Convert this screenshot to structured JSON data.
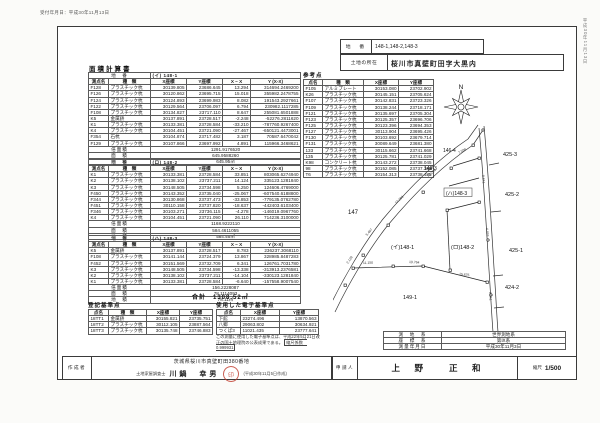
{
  "meta": {
    "top_note": "受付年月日：平成30年11月13日",
    "side_note": "平成30年11月13日"
  },
  "header": {
    "chiban_label": "地　番",
    "chiban": "148-1,148-2,148-3",
    "shozai_label": "土地の所在",
    "shozai": "桜川市真壁町田字大黒内"
  },
  "area_calc": {
    "title": "面積計算書",
    "tables": [
      {
        "rows": [
          [
            {
              "t": "地　番",
              "span": 2,
              "c": "lb"
            },
            {
              "t": "(イ) 148-1",
              "span": 4,
              "c": "tl"
            }
          ],
          [
            {
              "t": "測点名",
              "c": "h"
            },
            {
              "t": "種　類",
              "c": "h"
            },
            {
              "t": "X座標",
              "c": "h"
            },
            {
              "t": "Y座標",
              "c": "h"
            },
            {
              "t": "X − X",
              "c": "h"
            },
            {
              "t": "Y (X-X)",
              "c": "h"
            }
          ],
          [
            "F128",
            "プラスチック杭",
            "30139.805",
            "23686.645",
            "13.294",
            "314694.2469200"
          ],
          [
            "F126",
            "プラスチック杭",
            "30120.862",
            "23695.715",
            "15.018",
            "355982.2478755"
          ],
          [
            "F124",
            "プラスチック杭",
            "30124.893",
            "23699.983",
            "8.082",
            "191543.2927661"
          ],
          [
            "F122",
            "プラスチック杭",
            "30129.564",
            "23706.097",
            "6.794",
            "230982.1117285"
          ],
          [
            "F108",
            "プラスチック杭",
            "30134.827",
            "23717.110",
            "8.647",
            "255081.6501888"
          ],
          [
            "K5",
            "金属鋲",
            "30137.891",
            "23728.517",
            "-2.248",
            "-52276.2811620"
          ],
          [
            "K1",
            "プラスチック杭",
            "30133.381",
            "23728.584",
            "-33.210",
            "-787760.9267400"
          ],
          [
            "K4",
            "プラスチック杭",
            "30104.451",
            "23721.090",
            "-27.467",
            "-650121.4473001"
          ],
          [
            "F354",
            "石杭",
            "30104.874",
            "23717.482",
            "3.187",
            "70587.6470042"
          ],
          [
            "F129",
            "プラスチック杭",
            "30107.866",
            "23697.992",
            "4.891",
            "115966.3468621"
          ],
          [
            {
              "t": "倍面積",
              "span": 2,
              "c": "lb"
            },
            {
              "t": "1291.9176520",
              "span": 4,
              "c": "ct"
            }
          ],
          [
            {
              "t": "面　積",
              "span": 2,
              "c": "lb"
            },
            {
              "t": "645.9588260",
              "span": 4,
              "c": "ct"
            }
          ],
          [
            {
              "t": "地　積",
              "span": 2,
              "c": "lb"
            },
            {
              "t": "645.95㎡",
              "span": 4,
              "c": "ct"
            }
          ]
        ]
      },
      {
        "rows": [
          [
            {
              "t": "地　番",
              "span": 2,
              "c": "lb"
            },
            {
              "t": "(ロ) 148-2",
              "span": 4,
              "c": "tl"
            }
          ],
          [
            {
              "t": "測点名",
              "c": "h"
            },
            {
              "t": "種　類",
              "c": "h"
            },
            {
              "t": "X座標",
              "c": "h"
            },
            {
              "t": "Y座標",
              "c": "h"
            },
            {
              "t": "X − X",
              "c": "h"
            },
            {
              "t": "Y (X-X)",
              "c": "h"
            }
          ],
          [
            "K1",
            "プラスチック杭",
            "30133.381",
            "23728.584",
            "33.851",
            "803065.6274940"
          ],
          [
            "K2",
            "プラスチック杭",
            "30138.102",
            "23737.211",
            "14.124",
            "335123.1281840"
          ],
          [
            "K3",
            "プラスチック杭",
            "30148.505",
            "23734.598",
            "5.250",
            "124606.4769000"
          ],
          [
            "F450",
            "プラスチック杭",
            "30143.352",
            "23735.040",
            "-25.067",
            "-607540.6188800"
          ],
          [
            "F344",
            "プラスチック杭",
            "30130.868",
            "23737.473",
            "-33.853",
            "-779135.0762780"
          ],
          [
            "F451",
            "プラスチック杭",
            "30110.158",
            "23737.820",
            "-18.637",
            "-442403.6103400"
          ],
          [
            "F346",
            "プラスチック杭",
            "30103.271",
            "23736.115",
            "-4.278",
            "-146019.0967760"
          ],
          [
            "K4",
            "プラスチック杭",
            "30104.451",
            "23721.090",
            "26.110",
            "714236.3100000"
          ],
          [
            {
              "t": "倍面積",
              "span": 2,
              "c": "lb"
            },
            {
              "t": "1168.9222110",
              "span": 4,
              "c": "ct"
            }
          ],
          [
            {
              "t": "面　積",
              "span": 2,
              "c": "lb"
            },
            {
              "t": "584.4611055",
              "span": 4,
              "c": "ct"
            }
          ],
          [
            {
              "t": "地　積",
              "span": 2,
              "c": "lb"
            },
            {
              "t": "584.46㎡",
              "span": 4,
              "c": "ct"
            }
          ]
        ]
      },
      {
        "rows": [
          [
            {
              "t": "地　番",
              "span": 2,
              "c": "lb"
            },
            {
              "t": "(ハ) 148-3",
              "span": 4,
              "c": "tl"
            }
          ],
          [
            {
              "t": "測点名",
              "c": "h"
            },
            {
              "t": "種　類",
              "c": "h"
            },
            {
              "t": "X座標",
              "c": "h"
            },
            {
              "t": "Y座標",
              "c": "h"
            },
            {
              "t": "X − X",
              "c": "h"
            },
            {
              "t": "Y (X-X)",
              "c": "h"
            }
          ],
          [
            "K5",
            "金属鋲",
            "30137.891",
            "23728.517",
            "8.783",
            "236237.3068110"
          ],
          [
            "F108",
            "プラスチック杭",
            "30141.144",
            "23724.379",
            "13.867",
            "328985.8487283"
          ],
          [
            "F452",
            "プラスチック杭",
            "30151.569",
            "23732.709",
            "6.341",
            "126761.7031780"
          ],
          [
            "K3",
            "プラスチック杭",
            "30148.505",
            "23734.598",
            "-13.338",
            "-313913.2376581"
          ],
          [
            "K2",
            "プラスチック杭",
            "30138.102",
            "23737.211",
            "-14.104",
            "-330123.1281840"
          ],
          [
            "K1",
            "プラスチック杭",
            "30133.381",
            "23728.584",
            "-6.640",
            "-157558.9007540"
          ],
          [
            {
              "t": "倍面積",
              "span": 2,
              "c": "lb"
            },
            {
              "t": "156.2228087",
              "span": 4,
              "c": "ct"
            }
          ],
          [
            {
              "t": "面　積",
              "span": 2,
              "c": "lb"
            },
            {
              "t": "78.1114093",
              "span": 4,
              "c": "ct"
            }
          ],
          [
            {
              "t": "地　積",
              "span": 2,
              "c": "lb"
            },
            {
              "t": "78.11㎡",
              "span": 4,
              "c": "ct"
            }
          ]
        ]
      }
    ],
    "total": "合計　1308.52㎡"
  },
  "touki_kijun": {
    "title": "登記基準点",
    "rows": [
      [
        {
          "t": "点名",
          "c": "h"
        },
        {
          "t": "種　類",
          "c": "h"
        },
        {
          "t": "X座標",
          "c": "h"
        },
        {
          "t": "Y座標",
          "c": "h"
        }
      ],
      [
        "18TT1",
        "金属鋲",
        "30155.821",
        "23735.751"
      ],
      [
        "18TT2",
        "プラスチック杭",
        "30112.105",
        "23887.564"
      ],
      [
        "18TT3",
        "プラスチック杭",
        "30135.748",
        "23746.883"
      ]
    ]
  },
  "denshi_kijun": {
    "title": "使用した電子基準点",
    "rows": [
      [
        {
          "t": "点名",
          "c": "h"
        },
        {
          "t": "X座標",
          "c": "h"
        },
        {
          "t": "Y座標",
          "c": "h"
        }
      ],
      [
        "下館",
        "23274.496",
        "13870.563"
      ],
      [
        "八郷",
        "29063.802",
        "30634.921"
      ],
      [
        "つくば3",
        "11021.435",
        "23777.641"
      ]
    ],
    "note": "この測量に使用した電子基準点は、平成22年5月21日改正の国土地理院の公表成果である。",
    "scale_factor": "縮尺係数　0.999931"
  },
  "sankou": {
    "title": "参考点",
    "rows": [
      [
        {
          "t": "点名",
          "c": "h"
        },
        {
          "t": "種　類",
          "c": "h"
        },
        {
          "t": "X座標",
          "c": "h"
        },
        {
          "t": "Y座標",
          "c": "h"
        }
      ],
      [
        "F105",
        "アルミプレート",
        "30153.080",
        "23702.902"
      ],
      [
        "K26",
        "プラスチック杭",
        "30145.151",
        "23705.624"
      ],
      [
        "F107",
        "プラスチック杭",
        "30142.831",
        "23723.326"
      ],
      [
        "F109",
        "プラスチック杭",
        "30138.244",
        "23718.171"
      ],
      [
        "F121",
        "プラスチック杭",
        "30135.697",
        "23705.304"
      ],
      [
        "F123",
        "プラスチック杭",
        "30125.357",
        "23696.706"
      ],
      [
        "F125",
        "プラスチック杭",
        "30123.396",
        "23694.353"
      ],
      [
        "F127",
        "プラスチック杭",
        "30113.904",
        "23695.426"
      ],
      [
        "F130",
        "プラスチック杭",
        "30103.692",
        "23679.714"
      ],
      [
        "F131",
        "プラスチック杭",
        "30089.649",
        "23681.380"
      ],
      [
        "133",
        "プラスチック杭",
        "30115.662",
        "23741.668"
      ],
      [
        "135",
        "プラスチック杭",
        "30125.781",
        "23741.029"
      ],
      [
        "K98",
        "コンクリート杭",
        "30143.272",
        "23738.045"
      ],
      [
        "98",
        "プラスチック杭",
        "30152.085",
        "23737.365"
      ],
      [
        "T6",
        "プラスチック杭",
        "30154.313",
        "23738.485"
      ]
    ]
  },
  "geo": {
    "rows": [
      [
        {
          "t": "測　地　系",
          "c": "lb"
        },
        {
          "t": "世界測地系",
          "c": "ct"
        }
      ],
      [
        {
          "t": "座　標　系",
          "c": "lb"
        },
        {
          "t": "第Ⅸ系",
          "c": "ct"
        }
      ],
      [
        {
          "t": "測量年月日",
          "c": "lb"
        },
        {
          "t": "平成30年11月3日",
          "c": "ct"
        }
      ]
    ]
  },
  "maker": {
    "label": "作成者",
    "address": "茨城県桜川市真壁町田380番地",
    "role": "土地家屋調査士",
    "name": "川鍋　幸男",
    "seal": "印",
    "date_note": "(平成30年11月5日作成)"
  },
  "applicant": {
    "label": "申請人",
    "name": "上　野　　正　和"
  },
  "scale": {
    "label": "縮尺",
    "value": "1/500"
  },
  "map": {
    "north": "N",
    "labels": {
      "l147": "147",
      "l148_1": "(イ)148-1",
      "l148_2": "(ロ)148-2",
      "l148_3": "(ハ)148-3",
      "l146_4": "146-4",
      "l146_3": "146-3",
      "l425_3": "425-3",
      "l425_2": "425-2",
      "l425_1": "425-1",
      "l424_2": "424-2",
      "l149_1": "149-1"
    },
    "dist": {
      "d1": "13.294",
      "d2": "12.268",
      "d3": "7.598",
      "d4": "5.407",
      "d5": "2.128",
      "d6": "11.150",
      "d7": "19.764",
      "d8": "15.675",
      "d9": "8.641",
      "d10": "4.453",
      "d11": "6.341"
    }
  }
}
